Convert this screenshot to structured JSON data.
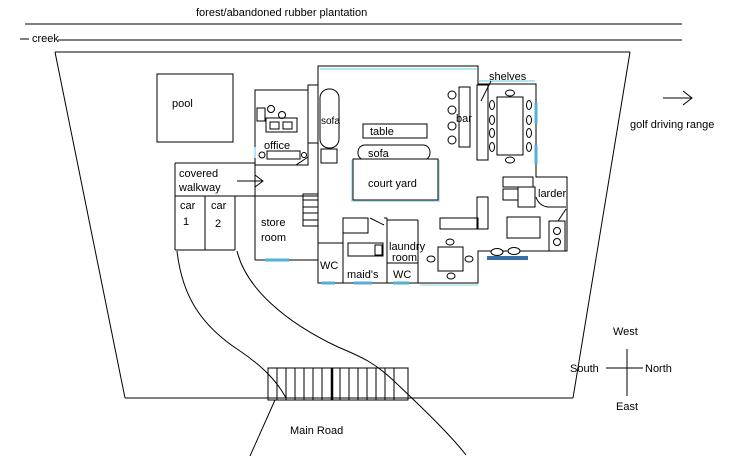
{
  "colors": {
    "ink": "#000000",
    "wall_highlight": "#aee6f2",
    "window": "#55b0d6",
    "door_strip": "#3a6ea5"
  },
  "site": {
    "title": "forest/abandoned rubber plantation",
    "creek": "creek",
    "golf": "golf driving range",
    "main_road": "Main Road",
    "compass": {
      "top": "West",
      "left": "South",
      "right": "North",
      "bottom": "East"
    }
  },
  "rooms": {
    "pool": "pool",
    "office": "office",
    "court_yard": "court yard",
    "larder": "larder",
    "wc": "WC",
    "maids": "maid's",
    "laundry": "laundry",
    "room": "room",
    "store": "store",
    "covered": "covered",
    "walkway": "walkway",
    "car": "car",
    "car1_num": "1",
    "car2_num": "2"
  },
  "furniture": {
    "sofa": "sofa",
    "table": "table",
    "bar": "bar",
    "shelves": "shelves"
  }
}
